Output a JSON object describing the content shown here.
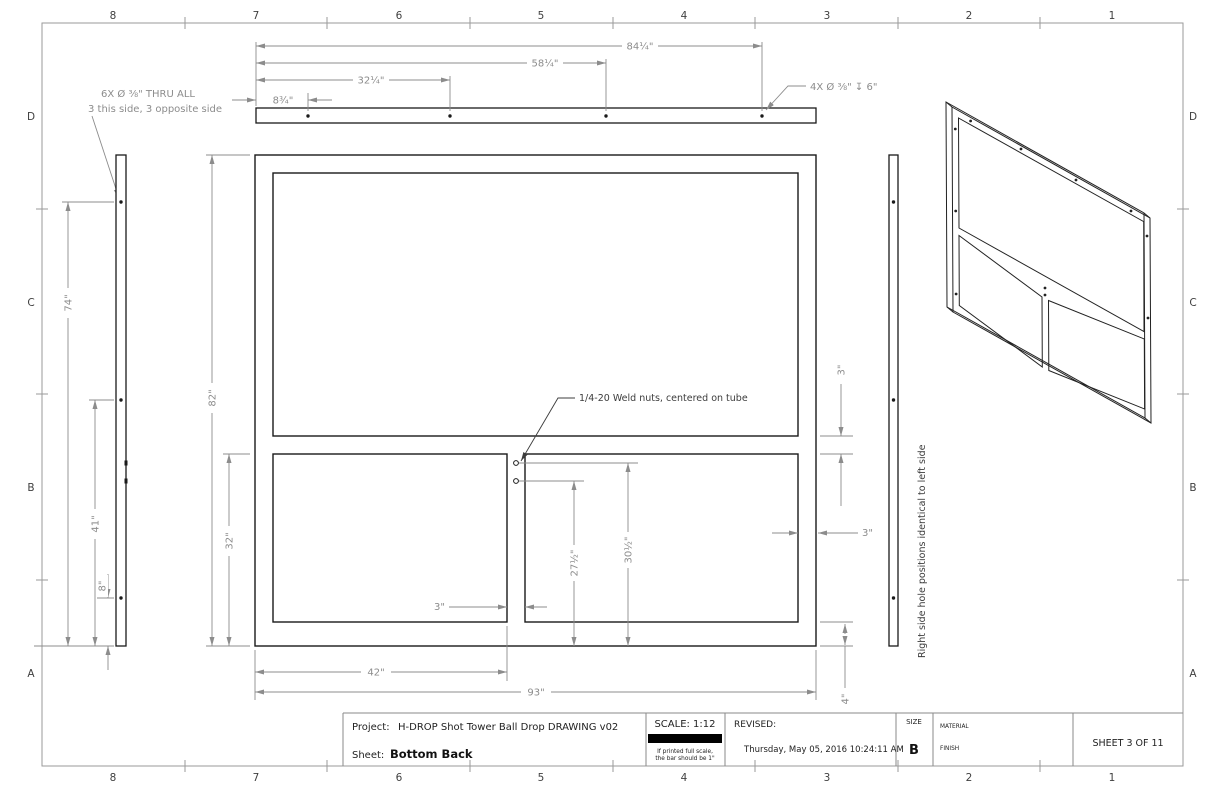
{
  "zones": {
    "columns": [
      "8",
      "7",
      "6",
      "5",
      "4",
      "3",
      "2",
      "1"
    ],
    "rows": [
      "D",
      "C",
      "B",
      "A"
    ]
  },
  "title_block": {
    "project_label": "Project:",
    "project": "H-DROP Shot Tower Ball Drop DRAWING v02",
    "sheet_label": "Sheet:",
    "sheet": "Bottom Back",
    "scale": "SCALE: 1:12",
    "scale_note1": "If printed full scale,",
    "scale_note2": "the bar should be 1\"",
    "revised_label": "REVISED:",
    "revised": "Thursday, May 05, 2016 10:24:11 AM",
    "size_label": "SIZE",
    "size": "B",
    "material_label": "MATERIAL",
    "finish_label": "FINISH",
    "sheet_of": "SHEET 3 OF 11"
  },
  "callouts": {
    "thru_holes": "6X Ø ⅜\" THRU ALL",
    "thru_holes_note": "3 this side, 3 opposite side",
    "counterbore": "4X Ø ⅜\" ↧ 6\"",
    "weld_nuts": "1/4-20 Weld nuts, centered on tube",
    "right_side": "Right side hole positions identical to left side"
  },
  "dims": {
    "top": {
      "d84": "84¼\"",
      "d58": "58¼\"",
      "d32": "32¼\"",
      "d8": "8¾\""
    },
    "left": {
      "d74": "74\"",
      "d41": "41\"",
      "d8": "8\""
    },
    "front": {
      "h": "82\"",
      "lower": "32\"",
      "w42": "42\"",
      "w93": "93\"",
      "div": "3\"",
      "rail": "3\"",
      "member": "3\"",
      "bottom": "4\"",
      "nut_low": "27½\"",
      "nut_high": "30½\""
    }
  },
  "colors": {
    "geometry": "#1a1a1a",
    "dimension": "#8c8c8c",
    "scale_bar": "#000000"
  }
}
